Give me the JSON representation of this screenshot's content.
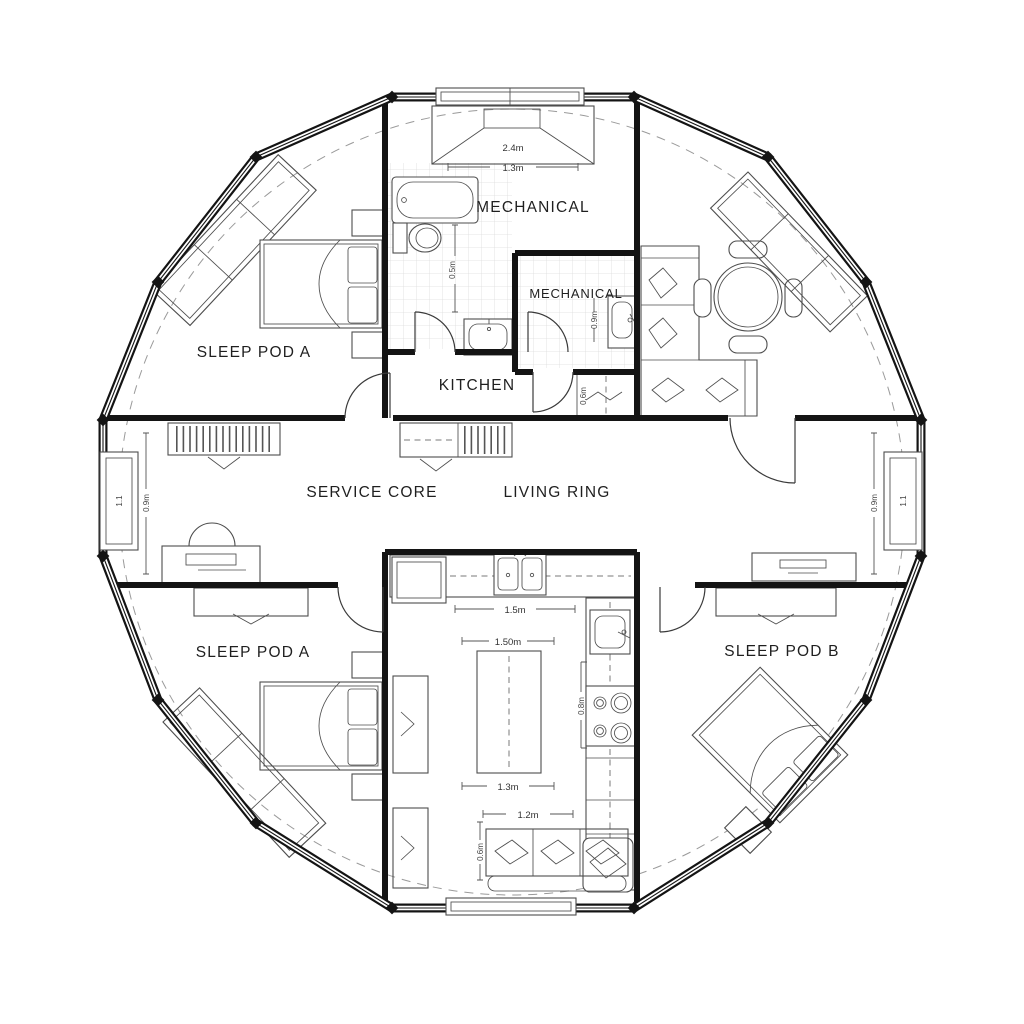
{
  "document": {
    "type": "architectural floor plan",
    "shape": "circular dome plan, 16-sided shell"
  },
  "labels": {
    "sleep_pod_a_top": "SLEEP POD A",
    "mechanical_upper": "MECHANICAL",
    "mechanical_inner": "MECHANICAL",
    "kitchen": "KITCHEN",
    "service_core": "SERVICE CORE",
    "living_ring": "LIVING RING",
    "sleep_pod_a_bottom": "SLEEP POD A",
    "sleep_pod_b": "SLEEP POD B"
  },
  "dims": {
    "vent_width": "2.4m",
    "vent_opening": "1.3m",
    "bath_clearance": "0.5m",
    "mech_sink_width": "0.9m",
    "hall_closet_depth": "0.6m",
    "counter_length": "1.5m",
    "island_length": "1.50m",
    "island_width": "1.3m",
    "sofa_length": "1.2m",
    "sofa_depth": "0.6m",
    "range_run": "0.8m",
    "window_left_width": "1.1",
    "window_left_height": "0.9m",
    "window_right_width": "1.1",
    "window_right_height": "0.9m"
  },
  "colors": {
    "wall": "#141414",
    "furniture_line": "#4d4d4d",
    "guide_dash": "#9a9a9a",
    "tile_grid": "#dcdcdc",
    "background": "#ffffff"
  }
}
